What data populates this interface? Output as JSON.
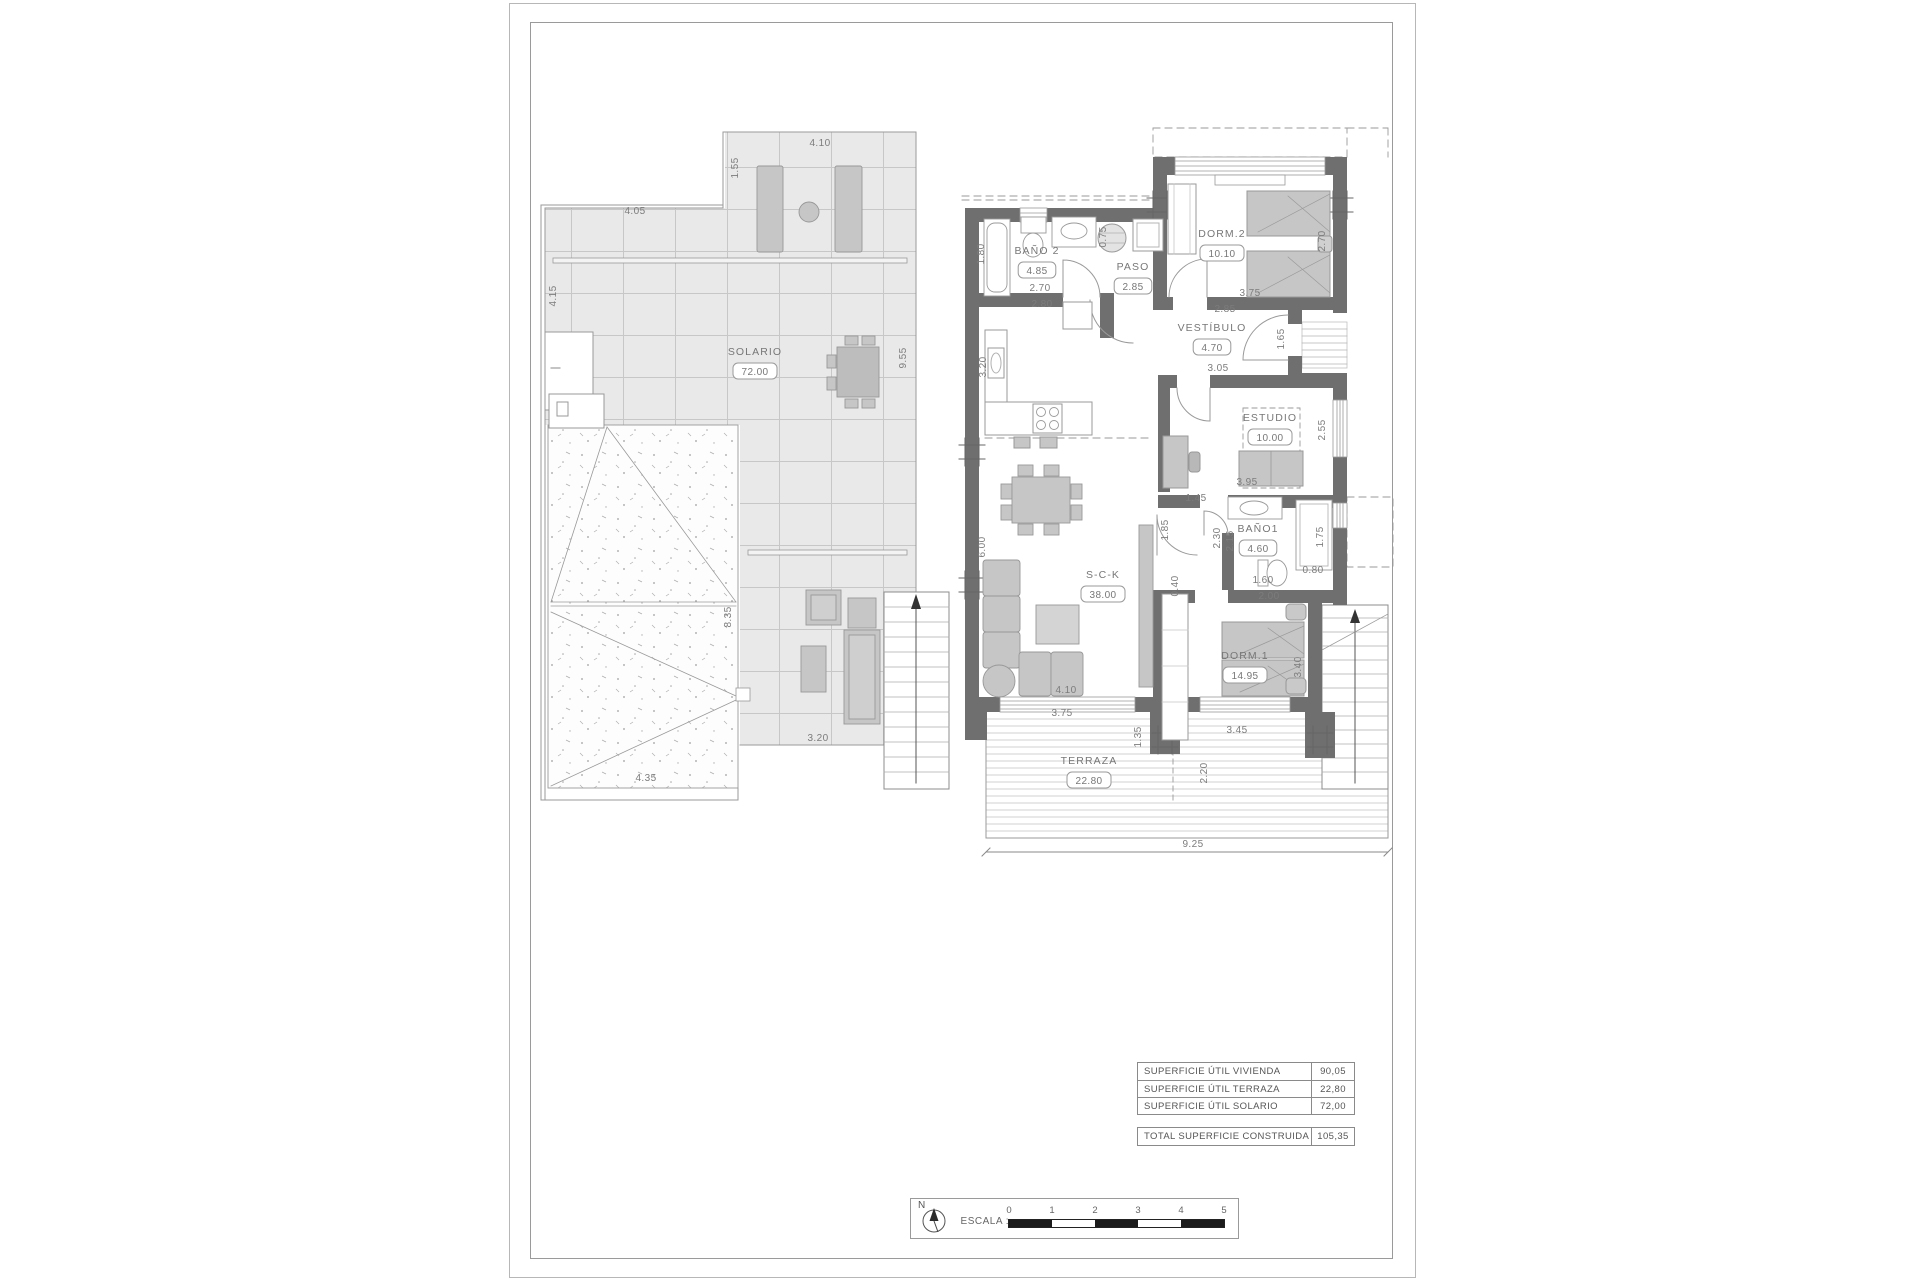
{
  "sheet": {
    "type": "architectural floor plan sheet"
  },
  "colors": {
    "wall": "#6f6f6f",
    "tile": "#e9e9e9",
    "furniture": "#c6c6c6",
    "line": "#9a9a9a",
    "text": "#7c7c7c",
    "scale_dark": "#1b1b1b"
  },
  "rooms": [
    {
      "name": "SOLARIO",
      "area": "72.00",
      "x": 755,
      "y": 355
    },
    {
      "name": "BAÑO 2",
      "area": "4.85",
      "x": 1037,
      "y": 254
    },
    {
      "name": "PASO",
      "area": "2.85",
      "x": 1133,
      "y": 270
    },
    {
      "name": "DORM.2",
      "area": "10.10",
      "x": 1222,
      "y": 237
    },
    {
      "name": "VESTÍBULO",
      "area": "4.70",
      "x": 1212,
      "y": 331
    },
    {
      "name": "ESTUDIO",
      "area": "10.00",
      "x": 1270,
      "y": 421
    },
    {
      "name": "BAÑO1",
      "area": "4.60",
      "x": 1258,
      "y": 532
    },
    {
      "name": "S-C-K",
      "area": "38.00",
      "x": 1103,
      "y": 578
    },
    {
      "name": "DORM.1",
      "area": "14.95",
      "x": 1245,
      "y": 659
    },
    {
      "name": "TERRAZA",
      "area": "22.80",
      "x": 1089,
      "y": 764
    }
  ],
  "dims": [
    {
      "t": "4.10",
      "x": 820,
      "y": 146
    },
    {
      "t": "1.55",
      "x": 738,
      "y": 168,
      "r": -90
    },
    {
      "t": "4.05",
      "x": 635,
      "y": 214
    },
    {
      "t": "4.15",
      "x": 556,
      "y": 296,
      "r": -90
    },
    {
      "t": "9.55",
      "x": 906,
      "y": 358,
      "r": -90
    },
    {
      "t": "8.35",
      "x": 731,
      "y": 617,
      "r": -90
    },
    {
      "t": "4.35",
      "x": 646,
      "y": 781
    },
    {
      "t": "3.20",
      "x": 818,
      "y": 741
    },
    {
      "t": "1.80",
      "x": 984,
      "y": 254,
      "r": -90
    },
    {
      "t": "2.70",
      "x": 1040,
      "y": 291
    },
    {
      "t": "2.80",
      "x": 1042,
      "y": 307
    },
    {
      "t": "0.75",
      "x": 1106,
      "y": 237,
      "r": -90
    },
    {
      "t": "3.20",
      "x": 986,
      "y": 367,
      "r": -90
    },
    {
      "t": "3.75",
      "x": 1250,
      "y": 296
    },
    {
      "t": "2.85",
      "x": 1225,
      "y": 312
    },
    {
      "t": "2.70",
      "x": 1325,
      "y": 241,
      "r": -90
    },
    {
      "t": "1.65",
      "x": 1284,
      "y": 339,
      "r": -90
    },
    {
      "t": "3.05",
      "x": 1218,
      "y": 371
    },
    {
      "t": "2.55",
      "x": 1325,
      "y": 430,
      "r": -90
    },
    {
      "t": "3.95",
      "x": 1247,
      "y": 485
    },
    {
      "t": "1.45",
      "x": 1196,
      "y": 501
    },
    {
      "t": "1.85",
      "x": 1168,
      "y": 530,
      "r": -90
    },
    {
      "t": "2.30",
      "x": 1220,
      "y": 538,
      "r": -90
    },
    {
      "t": "2.15",
      "x": 1233,
      "y": 541,
      "r": -90
    },
    {
      "t": "1.75",
      "x": 1323,
      "y": 537,
      "r": -90
    },
    {
      "t": "0.80",
      "x": 1313,
      "y": 573
    },
    {
      "t": "1.60",
      "x": 1263,
      "y": 583
    },
    {
      "t": "2.00",
      "x": 1269,
      "y": 599
    },
    {
      "t": "0.40",
      "x": 1178,
      "y": 586,
      "r": -90
    },
    {
      "t": "6.00",
      "x": 985,
      "y": 547,
      "r": -90
    },
    {
      "t": "3.40",
      "x": 1301,
      "y": 667,
      "r": -90
    },
    {
      "t": "4.10",
      "x": 1066,
      "y": 693
    },
    {
      "t": "3.75",
      "x": 1062,
      "y": 716
    },
    {
      "t": "1.35",
      "x": 1141,
      "y": 737,
      "r": -90
    },
    {
      "t": "3.45",
      "x": 1237,
      "y": 733
    },
    {
      "t": "2.20",
      "x": 1207,
      "y": 773,
      "r": -90
    },
    {
      "t": "9.25",
      "x": 1193,
      "y": 847
    }
  ],
  "areas_table": {
    "rows": [
      {
        "label": "SUPERFICIE ÚTIL VIVIENDA",
        "value": "90,05"
      },
      {
        "label": "SUPERFICIE ÚTIL TERRAZA",
        "value": "22,80"
      },
      {
        "label": "SUPERFICIE ÚTIL SOLARIO",
        "value": "72,00"
      }
    ],
    "total": {
      "label": "TOTAL SUPERFICIE CONSTRUIDA",
      "value": "105,35"
    }
  },
  "scale_bar": {
    "label": "ESCALA :",
    "north": "N",
    "ticks": [
      "0",
      "1",
      "2",
      "3",
      "4",
      "5"
    ],
    "segments": [
      "dark",
      "light",
      "dark",
      "light",
      "dark"
    ]
  }
}
